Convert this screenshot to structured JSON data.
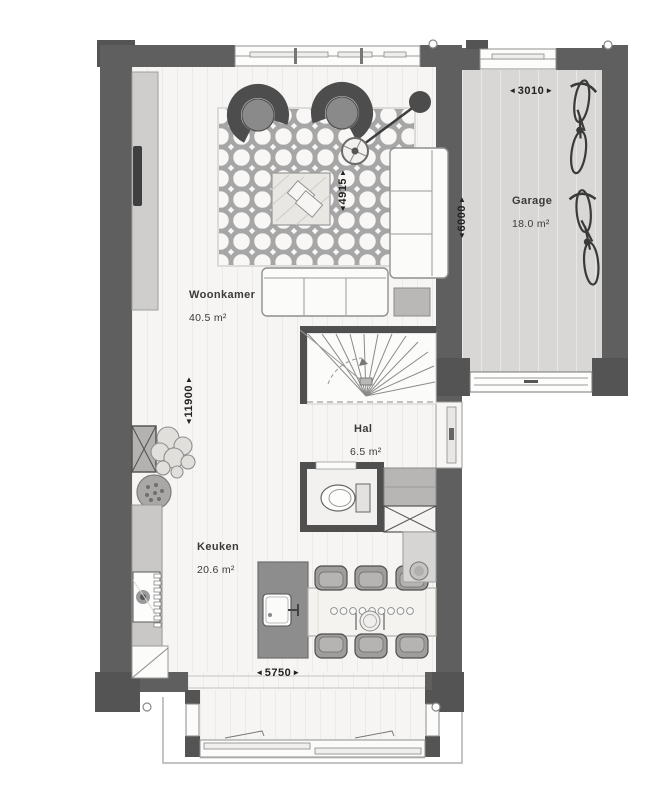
{
  "plan": {
    "rooms": {
      "woonkamer": {
        "name": "Woonkamer",
        "area": "40.5 m²"
      },
      "keuken": {
        "name": "Keuken",
        "area": "20.6 m²"
      },
      "hal": {
        "name": "Hal",
        "area": "6.5 m²"
      },
      "garage": {
        "name": "Garage",
        "area": "18.0 m²"
      }
    },
    "dimensions": {
      "garage_width": "3010",
      "garage_depth": "6000",
      "living_width": "4915",
      "house_depth": "11900",
      "house_width": "5750",
      "arrow_left": "◄",
      "arrow_right": "►",
      "arrow_up": "▲",
      "arrow_down": "▼"
    },
    "colors": {
      "wall": "#5f5f5f",
      "wall_dark": "#545454",
      "floor": "#f6f5f3",
      "garage_floor": "#d8d7d5",
      "line_gray": "#8a8a8a"
    }
  }
}
